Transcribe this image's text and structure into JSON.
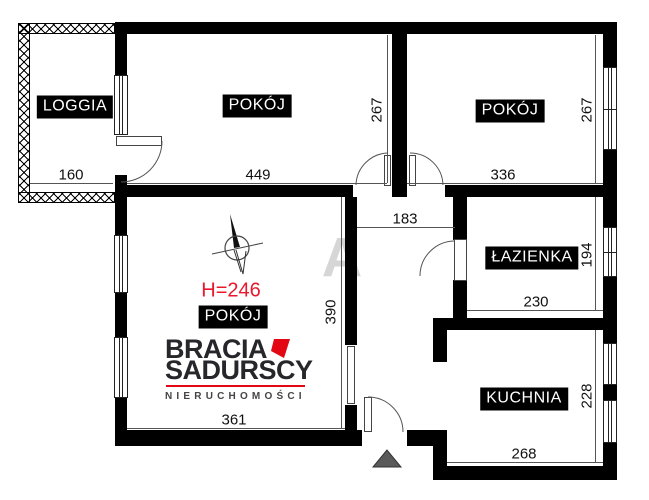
{
  "title": "Rzut mieszkania (floor plan)",
  "labels": {
    "loggia": "LOGGIA",
    "room_top_left": "POKÓJ",
    "room_top_right": "POKÓJ",
    "room_bottom": "POKÓJ",
    "bathroom": "ŁAZIENKA",
    "kitchen": "KUCHNIA"
  },
  "dims": {
    "loggia_w": "160",
    "room_tl_w": "449",
    "room_tl_h": "267",
    "room_tr_w": "336",
    "room_tr_h": "267",
    "hall_w": "183",
    "bath_w": "230",
    "bath_h": "194",
    "room_b_w": "361",
    "room_b_h": "390",
    "kitchen_w": "268",
    "kitchen_h": "228"
  },
  "ceiling_height": "H=246",
  "watermark": {
    "letter": "A"
  },
  "logo": {
    "brand_top": "BRACIA",
    "brand_bottom": "SADURSCY",
    "tagline": "NIERUCHOMOŚCI"
  },
  "icons": {
    "north_arrow": "compass-north-arrow",
    "entrance_marker": "entrance-triangle"
  },
  "colors": {
    "wall": "#000000",
    "brand_red": "#e30613",
    "height_note_red": "#e8192c",
    "entrance_marker": "#5a5a5a",
    "watermark_gray": "#d6d6d6"
  }
}
